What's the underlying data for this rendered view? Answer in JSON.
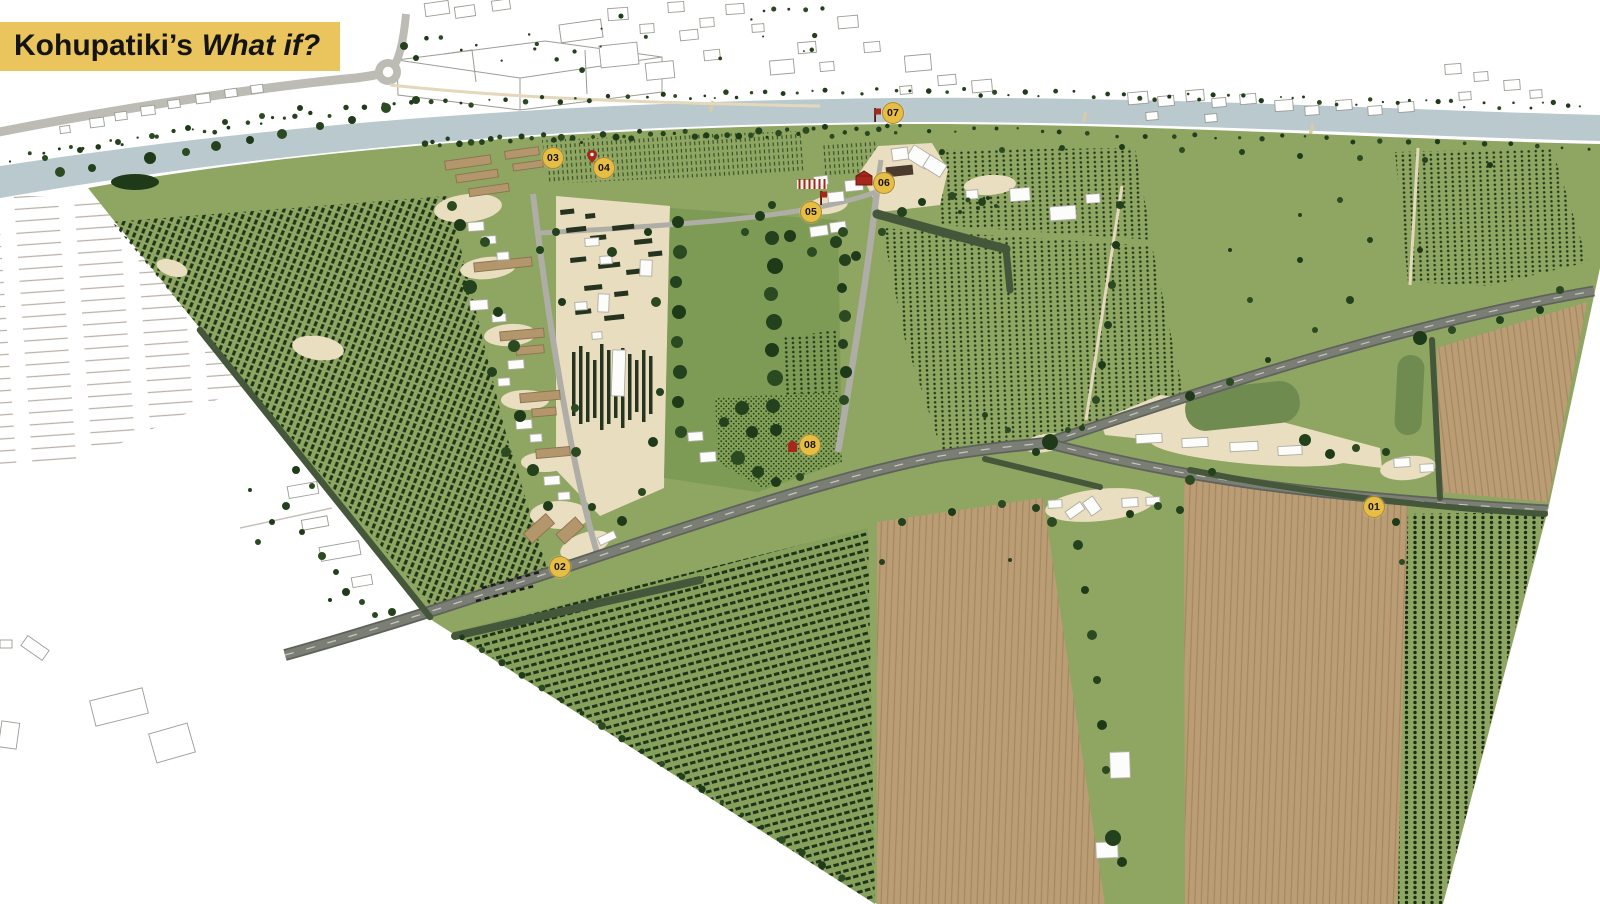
{
  "title": {
    "text": "Kohupatiki’s",
    "emphasis": "What if?"
  },
  "banner_color": "#EAC45C",
  "map": {
    "marker_color": "#E7BE45",
    "markers": [
      {
        "id": "01",
        "label": "01",
        "x": 1374,
        "y": 507
      },
      {
        "id": "02",
        "label": "02",
        "x": 560,
        "y": 567
      },
      {
        "id": "03",
        "label": "03",
        "x": 553,
        "y": 158
      },
      {
        "id": "04",
        "label": "04",
        "x": 604,
        "y": 168
      },
      {
        "id": "05",
        "label": "05",
        "x": 811,
        "y": 212
      },
      {
        "id": "06",
        "label": "06",
        "x": 884,
        "y": 183
      },
      {
        "id": "07",
        "label": "07",
        "x": 893,
        "y": 113
      },
      {
        "id": "08",
        "label": "08",
        "x": 810,
        "y": 445
      }
    ],
    "poi_icons": [
      {
        "type": "flag",
        "x": 876,
        "y": 122
      },
      {
        "type": "pin",
        "x": 592,
        "y": 163
      },
      {
        "type": "flag",
        "x": 822,
        "y": 205
      },
      {
        "type": "posts",
        "x": 812,
        "y": 190
      },
      {
        "type": "barn",
        "x": 864,
        "y": 186
      },
      {
        "type": "house",
        "x": 792,
        "y": 452
      }
    ],
    "palette": {
      "river": "#B9C9CD",
      "field_green": "#8FA562",
      "orchard_dark": "#20391B",
      "ploughed_tan": "#BB9D75",
      "path_cream": "#EADEC0",
      "accent_red": "#A6281C"
    }
  }
}
